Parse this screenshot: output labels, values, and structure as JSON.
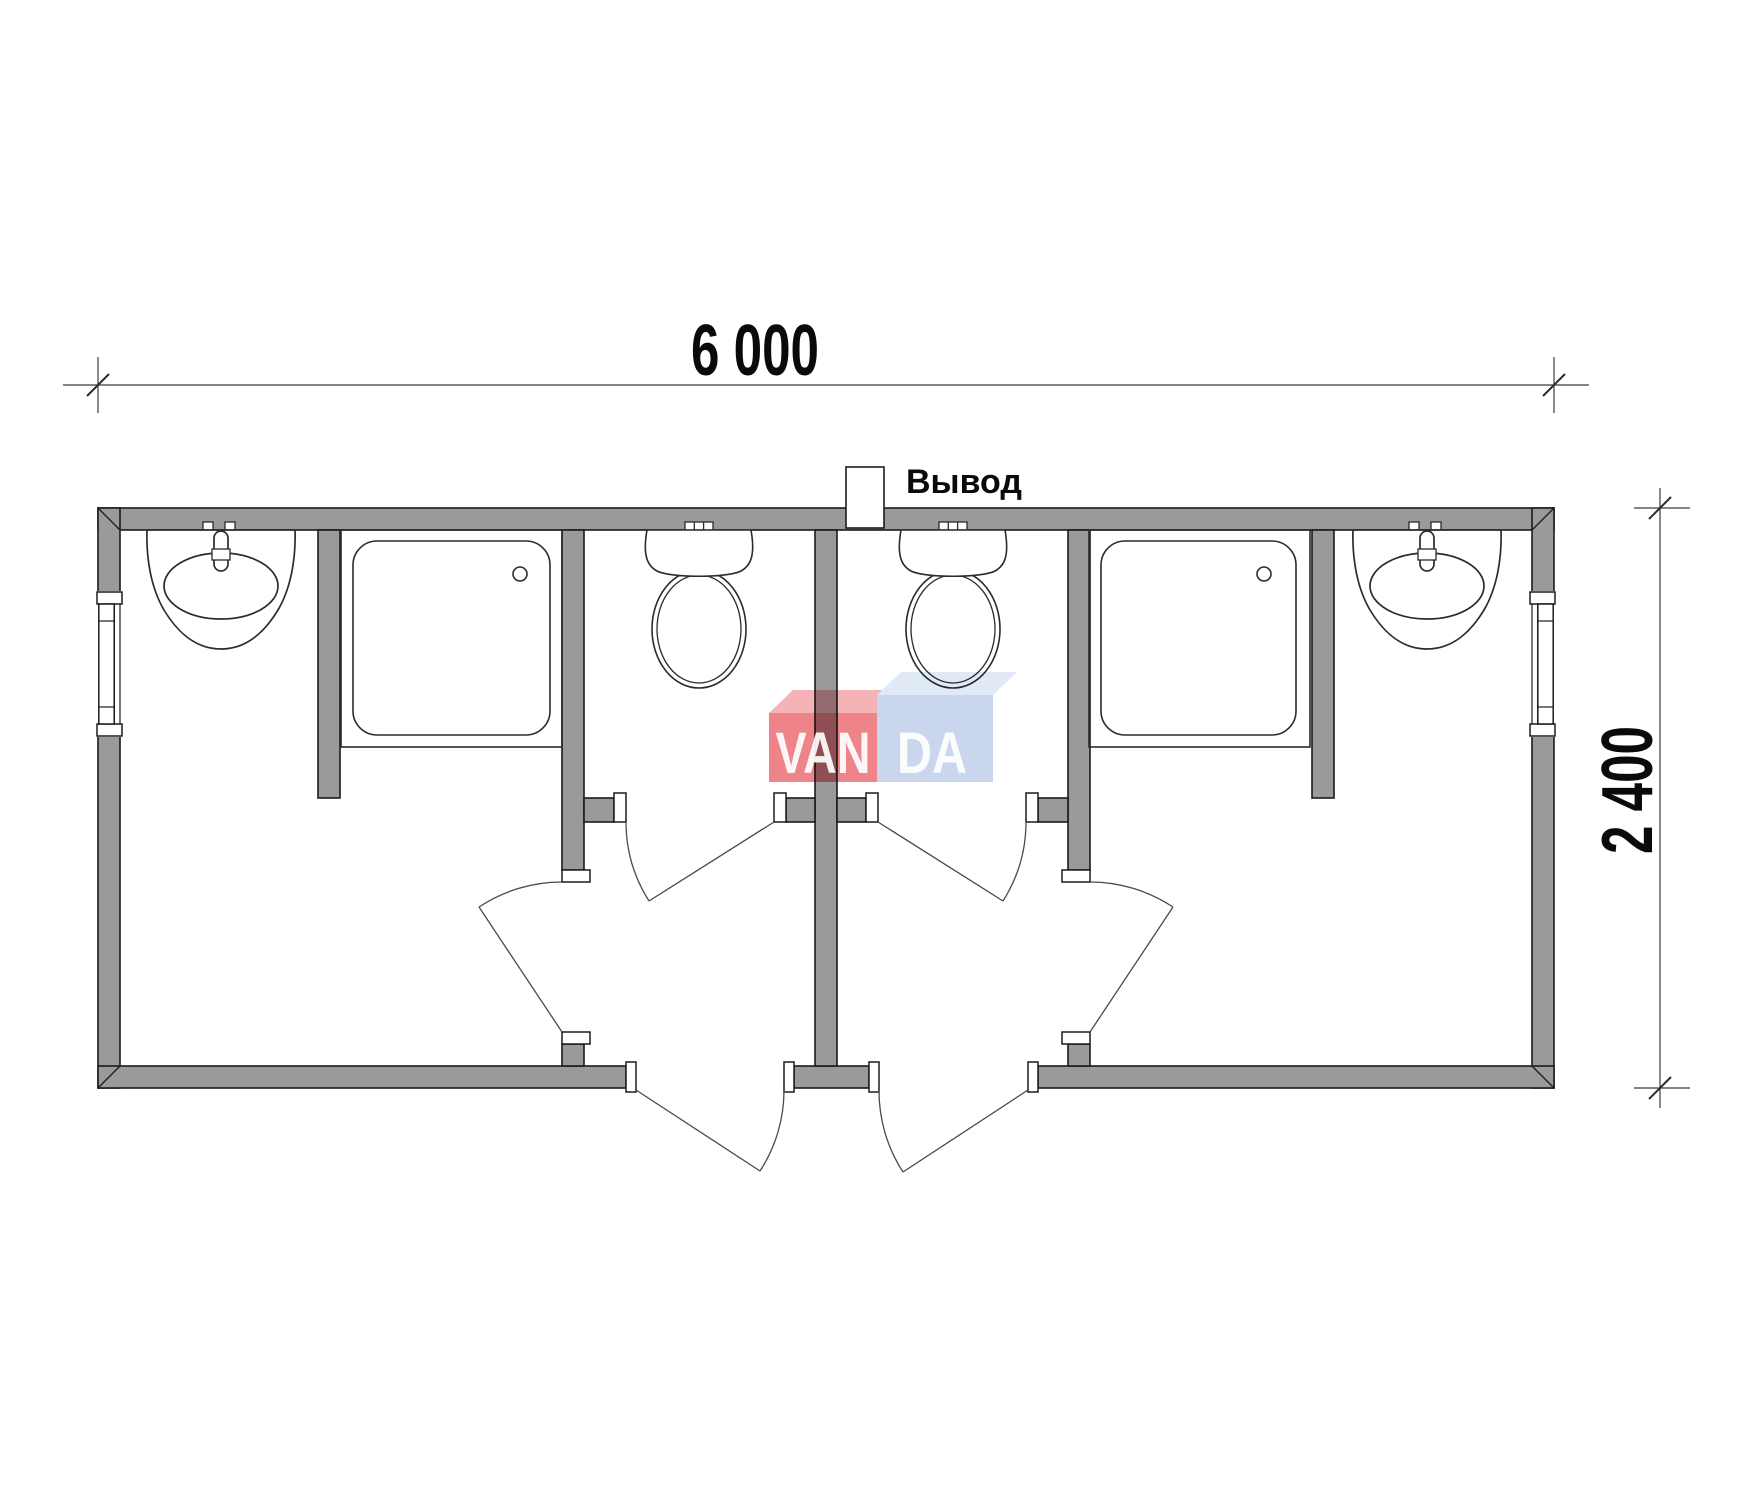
{
  "dimensions": {
    "width_label": "6 000",
    "height_label": "2 400"
  },
  "outlet": {
    "label": "Вывод"
  },
  "watermark": {
    "left_text": "VAN",
    "right_text": "DA",
    "red_front": "#ee838a",
    "red_top": "#f5b3b7",
    "blue_front": "#c9d6ee",
    "blue_top": "#e0e9f6"
  },
  "colors": {
    "background": "#ffffff",
    "wall_fill": "#9a9a9a",
    "outline": "#1c1c1c",
    "fixture_line": "#2b2b2b",
    "door_line": "#4a4a4a",
    "dimension_line": "#3c3c3c",
    "text": "#0a0a0a"
  },
  "plan": {
    "type": "floor-plan",
    "units": [
      {
        "side": "left",
        "fixtures": [
          "washbasin-icon",
          "shower-tray-icon",
          "toilet-icon"
        ],
        "window": true,
        "entrance_door": true,
        "wc_door": true,
        "room_door": true
      },
      {
        "side": "right",
        "fixtures": [
          "washbasin-icon",
          "shower-tray-icon",
          "toilet-icon"
        ],
        "window": true,
        "entrance_door": true,
        "wc_door": true,
        "room_door": true
      }
    ],
    "window_count": 2,
    "door_count": 6
  }
}
